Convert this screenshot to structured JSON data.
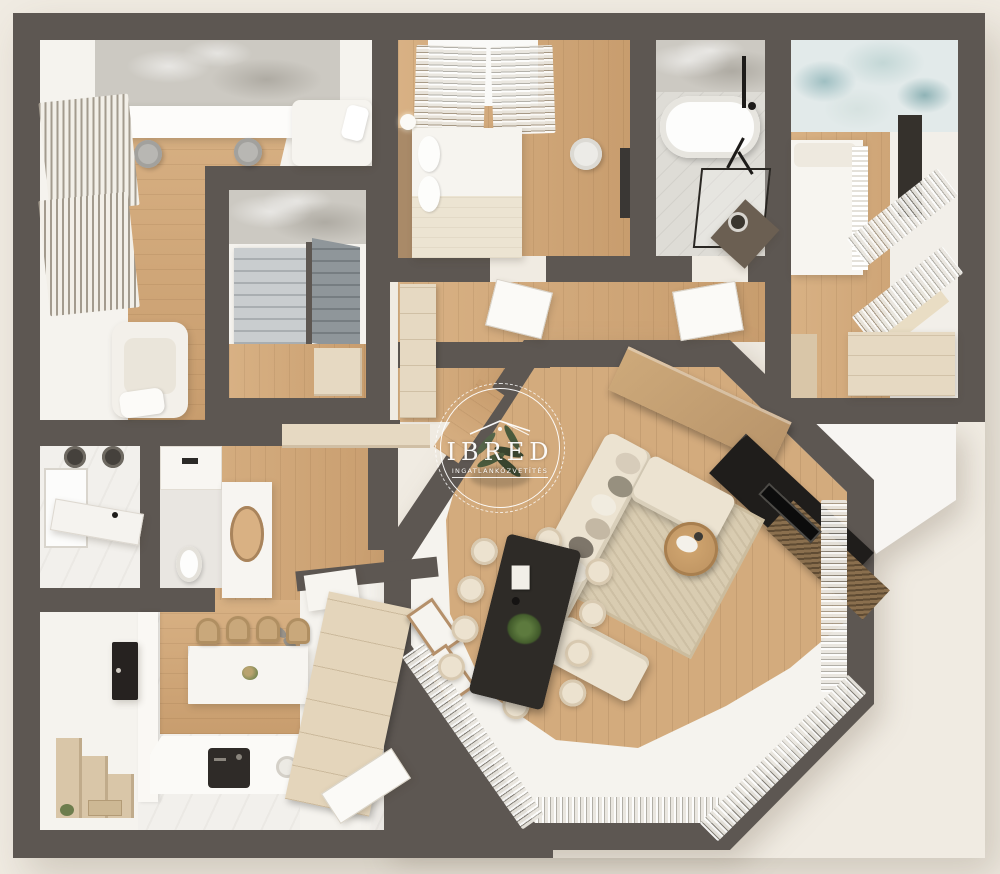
{
  "watermark": {
    "brand": "IBRED",
    "subtitle": "INGATLANKÖZVETÍTÉS",
    "icon": "house-roof-icon"
  },
  "palette": {
    "bg": "#f0ebe2",
    "wall": "#5d5752",
    "floor": "#f5f3ee",
    "marble": "#f2f0ec",
    "wood1": "#d8b184",
    "wood2": "#c89d6e",
    "beige": "#e6d9c2",
    "beige2": "#d9c6a8",
    "dark": "#2c2926",
    "concrete": "#ccc9c2",
    "mural": "#bcd2d3",
    "sofa": "#ece3d1",
    "stepl": "#c9cdcf",
    "stepd": "#8f969a",
    "green": "#42502f",
    "white": "#ffffff"
  }
}
